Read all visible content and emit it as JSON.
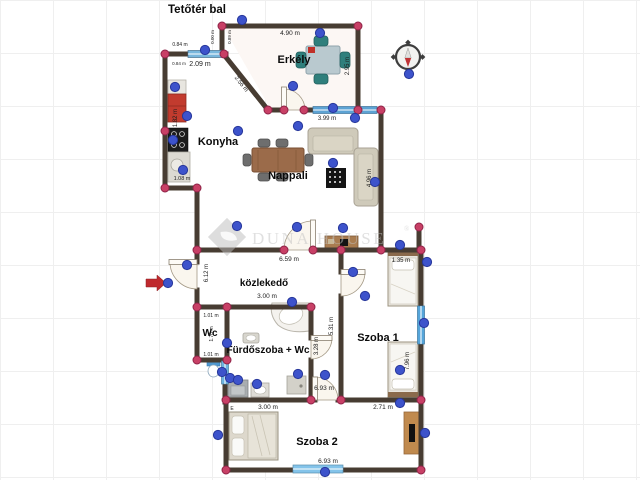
{
  "title": "Tetőtér bal",
  "watermark": {
    "brand": "DUNA HOUSE",
    "registered": "®"
  },
  "room_labels": [
    {
      "id": "erkely",
      "text": "Erkély",
      "x": 294,
      "y": 63,
      "size": 11
    },
    {
      "id": "konyha",
      "text": "Konyha",
      "x": 218,
      "y": 145,
      "size": 11
    },
    {
      "id": "nappali",
      "text": "Nappali",
      "x": 288,
      "y": 179,
      "size": 11
    },
    {
      "id": "kozlekedo",
      "text": "közlekedő",
      "x": 264,
      "y": 286,
      "size": 10
    },
    {
      "id": "wc",
      "text": "Wc",
      "x": 210,
      "y": 336,
      "size": 10
    },
    {
      "id": "furdoszoba",
      "text": "Fürdőszoba + Wc",
      "x": 268,
      "y": 353,
      "size": 10
    },
    {
      "id": "szoba1",
      "text": "Szoba 1",
      "x": 378,
      "y": 341,
      "size": 11
    },
    {
      "id": "szoba2",
      "text": "Szoba 2",
      "x": 317,
      "y": 445,
      "size": 11
    }
  ],
  "measurements": [
    {
      "text": "0.84 m",
      "x": 180,
      "y": 46,
      "rot": 0,
      "size": 5
    },
    {
      "text": "0.00 m",
      "x": 214,
      "y": 37,
      "rot": -90,
      "size": 4.5
    },
    {
      "text": "0.89 m",
      "x": 231,
      "y": 37,
      "rot": -90,
      "size": 4.5
    },
    {
      "text": "4.90 m",
      "x": 290,
      "y": 35,
      "rot": 0,
      "size": 6.5
    },
    {
      "text": "2.95 m",
      "x": 349,
      "y": 66,
      "rot": -90,
      "size": 6
    },
    {
      "text": "2.56 m",
      "x": 240,
      "y": 85,
      "rot": 52,
      "size": 6
    },
    {
      "text": "0.84 m",
      "x": 179,
      "y": 65,
      "rot": 0,
      "size": 4.5
    },
    {
      "text": "2.09 m",
      "x": 200,
      "y": 66,
      "rot": 0,
      "size": 7
    },
    {
      "text": "3.99 m",
      "x": 327,
      "y": 120,
      "rot": 0,
      "size": 6
    },
    {
      "text": "1.82 m",
      "x": 177,
      "y": 118,
      "rot": -90,
      "size": 6
    },
    {
      "text": "1.08 m",
      "x": 182,
      "y": 180,
      "rot": 0,
      "size": 5.5
    },
    {
      "text": "4.96 m",
      "x": 371,
      "y": 178,
      "rot": -90,
      "size": 6
    },
    {
      "text": "6.59 m",
      "x": 289,
      "y": 261,
      "rot": 0,
      "size": 6.5
    },
    {
      "text": "6.12 m",
      "x": 208,
      "y": 273,
      "rot": -90,
      "size": 6
    },
    {
      "text": "3.00 m",
      "x": 267,
      "y": 298,
      "rot": 0,
      "size": 6.5
    },
    {
      "text": "1.01 m",
      "x": 211,
      "y": 317,
      "rot": 0,
      "size": 5
    },
    {
      "text": "1.70 m",
      "x": 213,
      "y": 334,
      "rot": -90,
      "size": 5
    },
    {
      "text": "1.01 m",
      "x": 211,
      "y": 356,
      "rot": 0,
      "size": 5
    },
    {
      "text": "5.31 m",
      "x": 333,
      "y": 326,
      "rot": -90,
      "size": 6
    },
    {
      "text": "1.35 m",
      "x": 401,
      "y": 262,
      "rot": 0,
      "size": 6
    },
    {
      "text": "3.28 m",
      "x": 318,
      "y": 346,
      "rot": -90,
      "size": 6
    },
    {
      "text": "6.93 m",
      "x": 324,
      "y": 390,
      "rot": 0,
      "size": 6.5
    },
    {
      "text": "7.96 m",
      "x": 409,
      "y": 361,
      "rot": -90,
      "size": 6
    },
    {
      "text": "3.00 m",
      "x": 268,
      "y": 409,
      "rot": 0,
      "size": 6.5
    },
    {
      "text": "2.71 m",
      "x": 383,
      "y": 409,
      "rot": 0,
      "size": 6.5
    },
    {
      "text": "6.93 m",
      "x": 328,
      "y": 463,
      "rot": 0,
      "size": 6.5
    },
    {
      "text": "E",
      "x": 232,
      "y": 410,
      "rot": 0,
      "size": 5
    }
  ],
  "editor_nodes": {
    "corners": [
      [
        222,
        26
      ],
      [
        358,
        26
      ],
      [
        165,
        54
      ],
      [
        224,
        54
      ],
      [
        268,
        110
      ],
      [
        284,
        110
      ],
      [
        304,
        110
      ],
      [
        358,
        110
      ],
      [
        381,
        110
      ],
      [
        165,
        131
      ],
      [
        165,
        188
      ],
      [
        197,
        188
      ],
      [
        197,
        250
      ],
      [
        284,
        250
      ],
      [
        313,
        250
      ],
      [
        341,
        250
      ],
      [
        381,
        250
      ],
      [
        419,
        227
      ],
      [
        421,
        250
      ],
      [
        197,
        307
      ],
      [
        227,
        307
      ],
      [
        311,
        307
      ],
      [
        197,
        360
      ],
      [
        227,
        360
      ],
      [
        226,
        400
      ],
      [
        311,
        400
      ],
      [
        341,
        400
      ],
      [
        421,
        400
      ],
      [
        226,
        470
      ],
      [
        421,
        470
      ]
    ],
    "handles": [
      [
        242,
        20
      ],
      [
        205,
        50
      ],
      [
        320,
        33
      ],
      [
        409,
        74
      ],
      [
        293,
        86
      ],
      [
        333,
        108
      ],
      [
        355,
        118
      ],
      [
        175,
        87
      ],
      [
        187,
        116
      ],
      [
        173,
        140
      ],
      [
        183,
        170
      ],
      [
        238,
        131
      ],
      [
        298,
        126
      ],
      [
        333,
        163
      ],
      [
        375,
        182
      ],
      [
        343,
        228
      ],
      [
        297,
        227
      ],
      [
        237,
        226
      ],
      [
        427,
        262
      ],
      [
        187,
        265
      ],
      [
        168,
        283
      ],
      [
        353,
        272
      ],
      [
        292,
        302
      ],
      [
        227,
        343
      ],
      [
        424,
        323
      ],
      [
        400,
        245
      ],
      [
        365,
        296
      ],
      [
        222,
        372
      ],
      [
        230,
        378
      ],
      [
        238,
        380
      ],
      [
        257,
        384
      ],
      [
        298,
        374
      ],
      [
        325,
        375
      ],
      [
        400,
        370
      ],
      [
        218,
        435
      ],
      [
        400,
        403
      ],
      [
        425,
        433
      ],
      [
        325,
        472
      ]
    ]
  },
  "colors": {
    "wall": "#473c32",
    "window": "#5da3d4",
    "corner_node": "#c84066",
    "handle_node": "#3d53cb",
    "entry_arrow": "#bf2a2e",
    "compass_needle_red": "#bf3336",
    "fridge_red": "#c23b2e",
    "watermark_gray": "#c2c2c2"
  }
}
